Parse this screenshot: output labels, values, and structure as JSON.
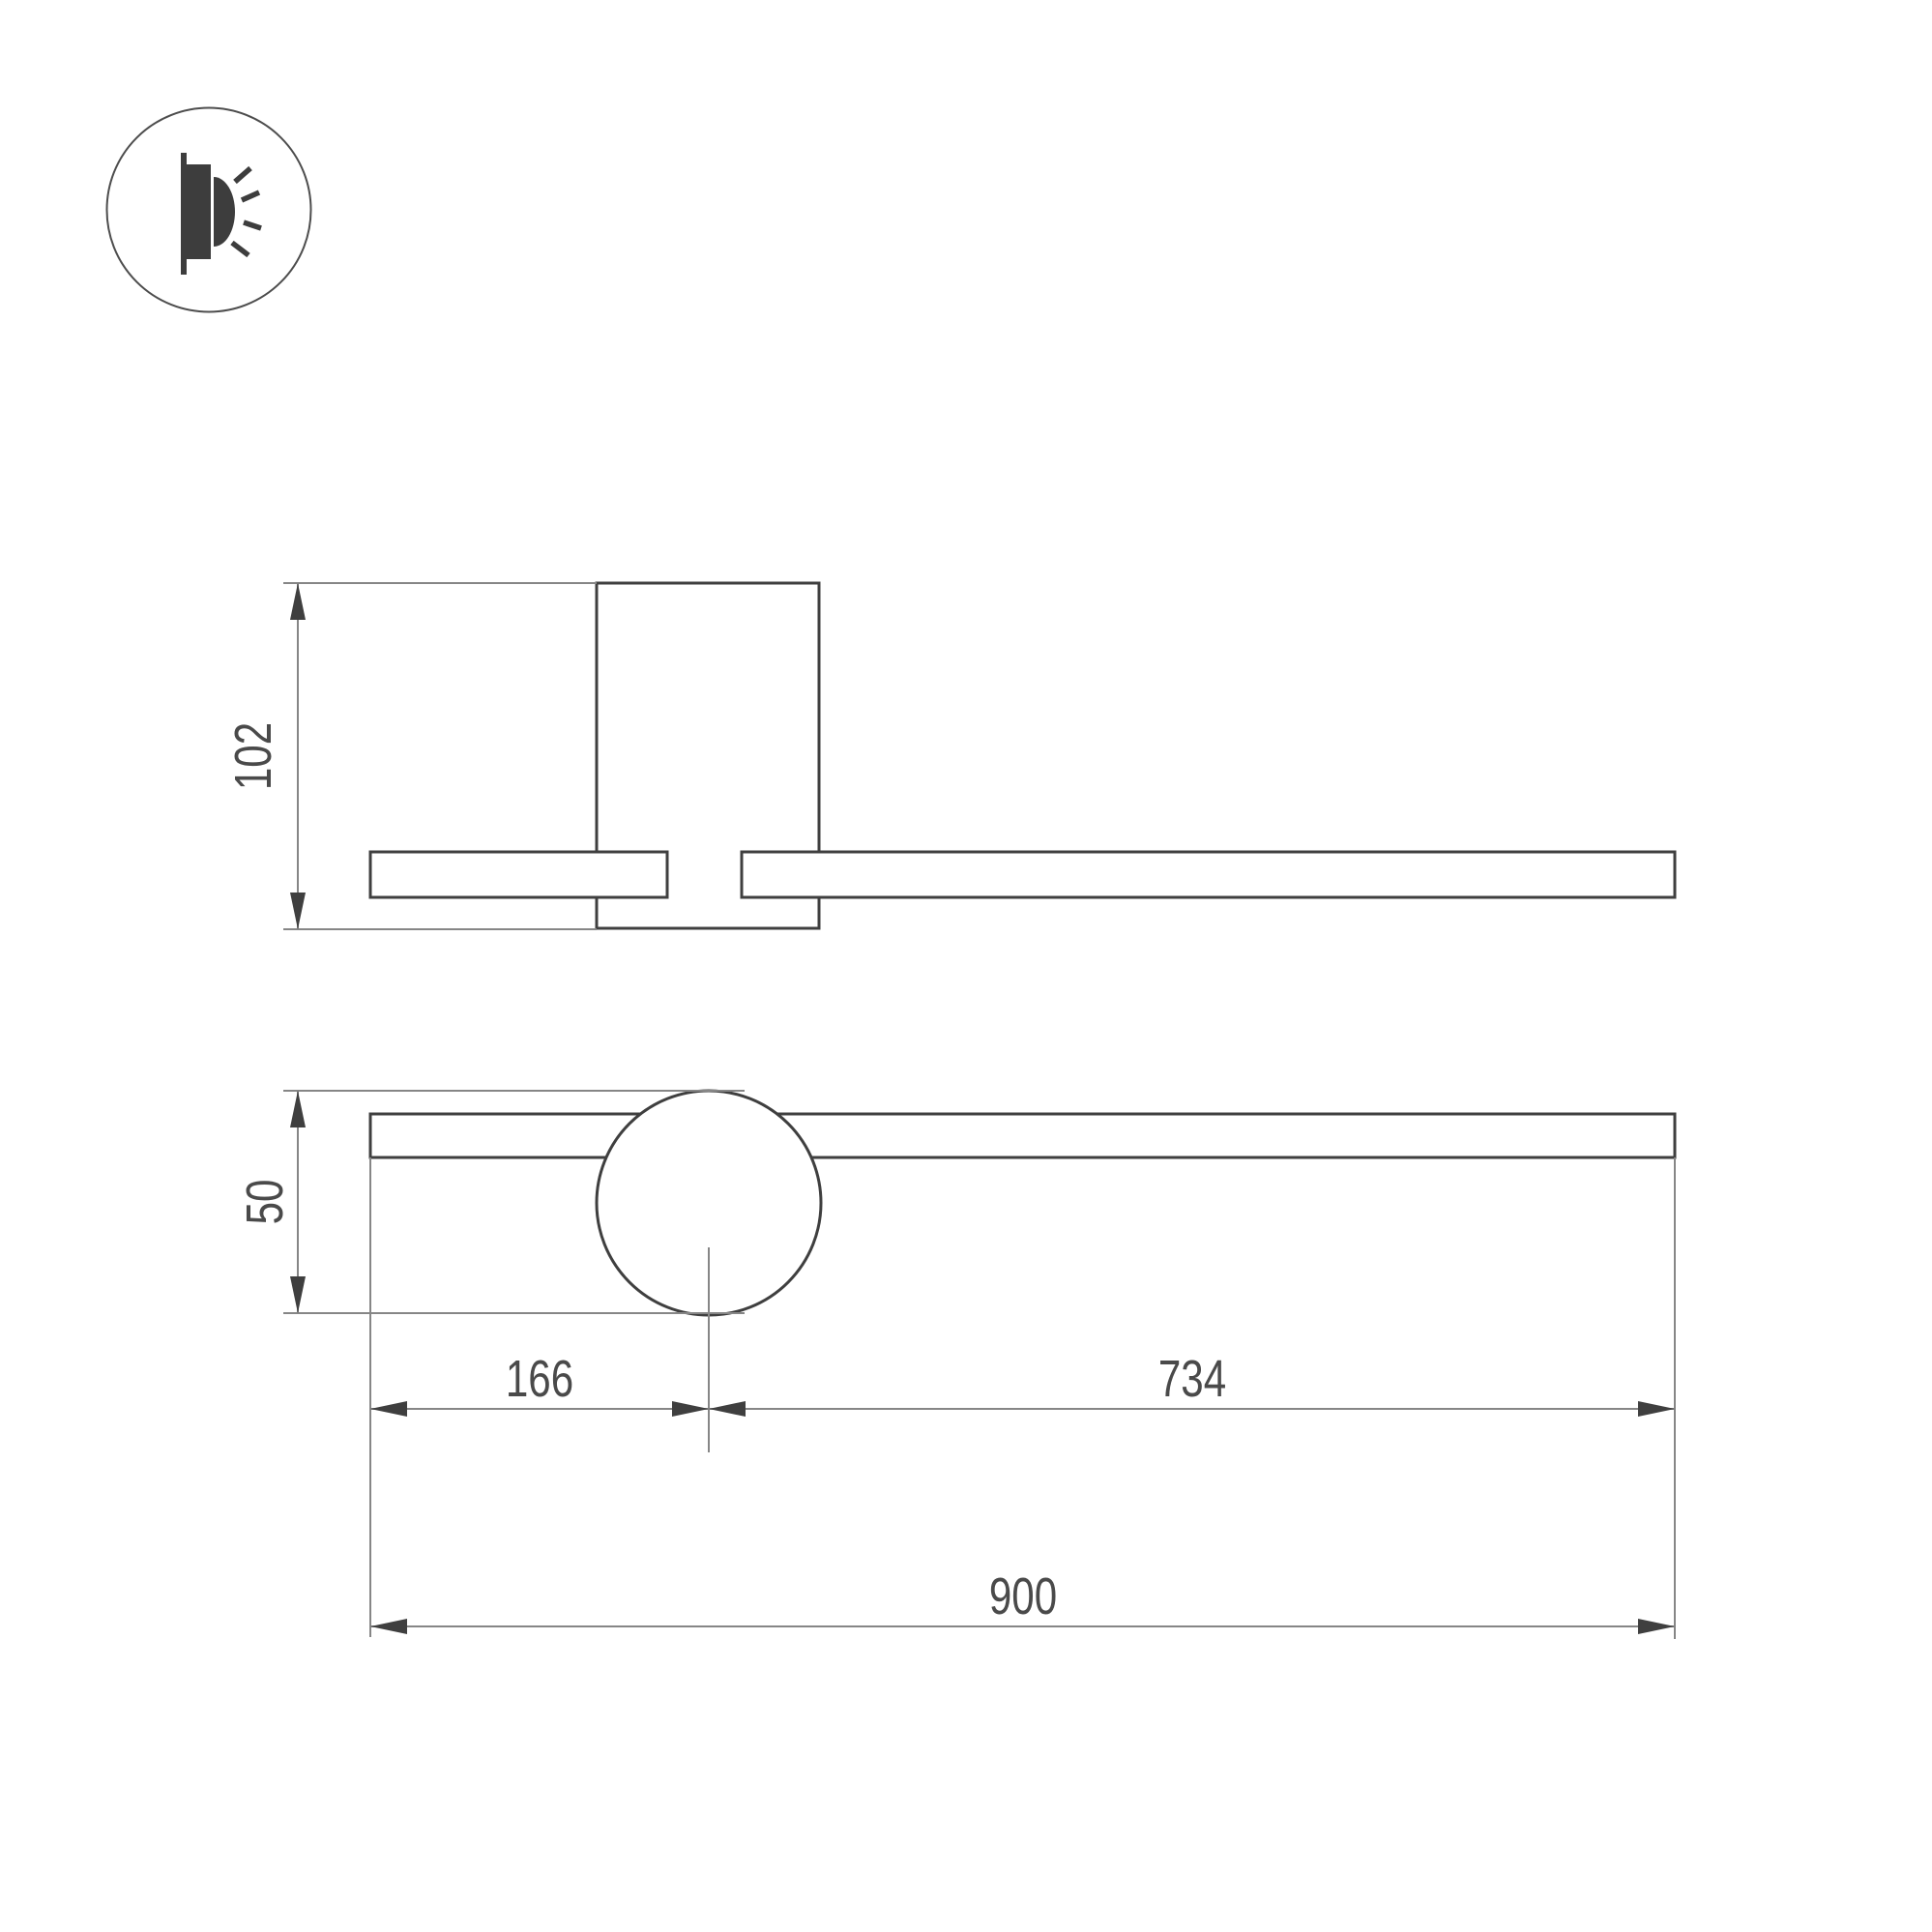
{
  "drawing": {
    "type": "technical-dimension-drawing",
    "product": "wall-mounted linear luminaire",
    "background_color": "#ffffff",
    "outline_color": "#3f3f3f",
    "thin_line_color": "#868686",
    "text_color": "#4a4a4a",
    "icon": {
      "name": "wall-light-icon",
      "description": "circled pictogram of a wall-mounted lamp emitting light rays"
    },
    "views": {
      "side_view": {
        "parts": [
          "wall-plate",
          "arm-left-segment",
          "arm-right-segment"
        ],
        "dimensions": {
          "height": "102"
        }
      },
      "front_view": {
        "parts": [
          "arm-bar",
          "lamp-head-circle",
          "center-line"
        ],
        "dimensions": {
          "overall_height": "50",
          "left_end_to_head_center": "166",
          "head_center_to_right_end": "734",
          "overall_length": "900"
        }
      }
    }
  },
  "dimensions": {
    "side_height": "102",
    "front_height": "50",
    "left_offset": "166",
    "right_offset": "734",
    "total_length": "900"
  }
}
